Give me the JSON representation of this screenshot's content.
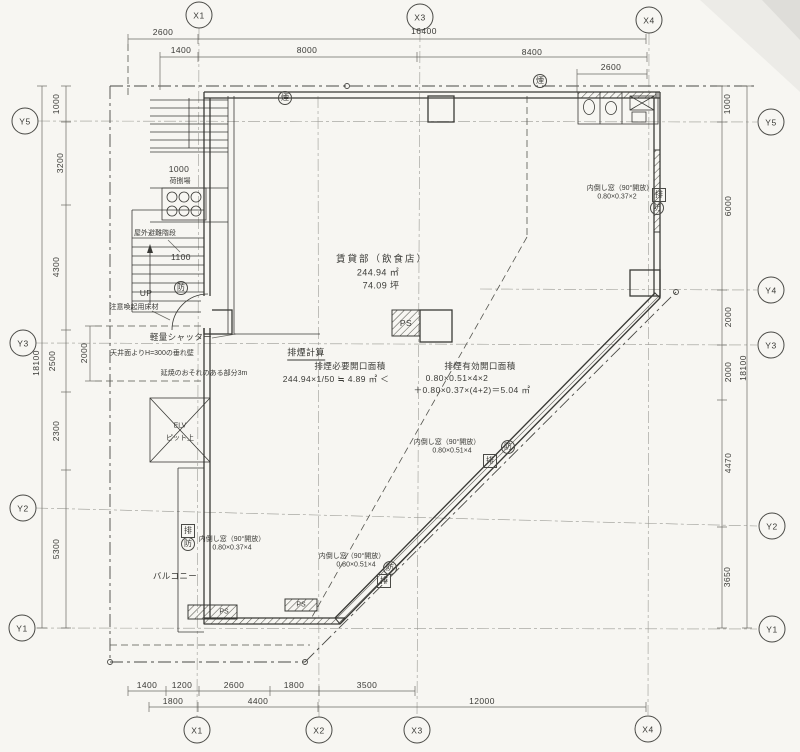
{
  "colors": {
    "paper": "#f7f6f2",
    "ink": "#3a3a36",
    "faint": "#9a9a94"
  },
  "grid": {
    "top": [
      "X1",
      "X3",
      "X4"
    ],
    "bottom": [
      "X1",
      "X2",
      "X3",
      "X4"
    ],
    "left": [
      "Y5",
      "Y3",
      "Y2",
      "Y1"
    ],
    "right": [
      "Y5",
      "Y4",
      "Y3",
      "Y2",
      "Y1"
    ]
  },
  "dims": {
    "top": [
      "2600",
      "16400",
      "1400",
      "8000",
      "8400",
      "2600"
    ],
    "bottom_row1": [
      "1400",
      "1200",
      "2600",
      "1800",
      "3500"
    ],
    "bottom_row2": [
      "1800",
      "4400",
      "12000"
    ],
    "left": [
      "1000",
      "3200",
      "4300",
      "2500",
      "2300",
      "5300"
    ],
    "left_total": "18100",
    "left_inner": "2000",
    "right": [
      "1000",
      "6000",
      "2000",
      "2000",
      "4470",
      "3650"
    ],
    "right_total": "18100",
    "stair": [
      "1000",
      "1100"
    ]
  },
  "room": {
    "title": "賃貸部（飲食店）",
    "area_m2": "244.94 ㎡",
    "area_tsubo": "74.09 坪"
  },
  "calc": {
    "title": "排煙計算",
    "required_label": "排煙必要開口面積",
    "required_formula": "244.94×1/50 ≒ 4.89 ㎡ ＜",
    "effective_label": "排煙有効開口面積",
    "effective_formula1": "0.80×0.51×4×2",
    "effective_formula2": "＋0.80×0.37×(4+2)＝5.04 ㎡"
  },
  "windows": {
    "right": {
      "name": "内倒し窓（90°開放）",
      "size": "0.80×0.37×2"
    },
    "diag_upper": {
      "name": "内倒し窓（90°開放）",
      "size": "0.80×0.51×4"
    },
    "diag_lower": {
      "name": "内倒し窓（90°開放）",
      "size": "0.80×0.51×4"
    },
    "left": {
      "name": "内倒し窓（90°開放）",
      "size": "0.80×0.37×4"
    }
  },
  "notes": {
    "shutter": "軽量シャッター",
    "tarekabe": "天井面よりH=300の垂れ壁",
    "ensho": "延焼のおそれのある部分3m",
    "warning_floor": "注意喚起用床材",
    "escape_stair": "屋外避難階段",
    "loading": "荷捌場",
    "up": "UP",
    "elevator": "ELV",
    "elevator_sub": "ピット上",
    "balcony": "バルコニー",
    "ps": "PS"
  },
  "symbols": {
    "smoke": "煙",
    "fire": "防",
    "exhaust": "排"
  }
}
